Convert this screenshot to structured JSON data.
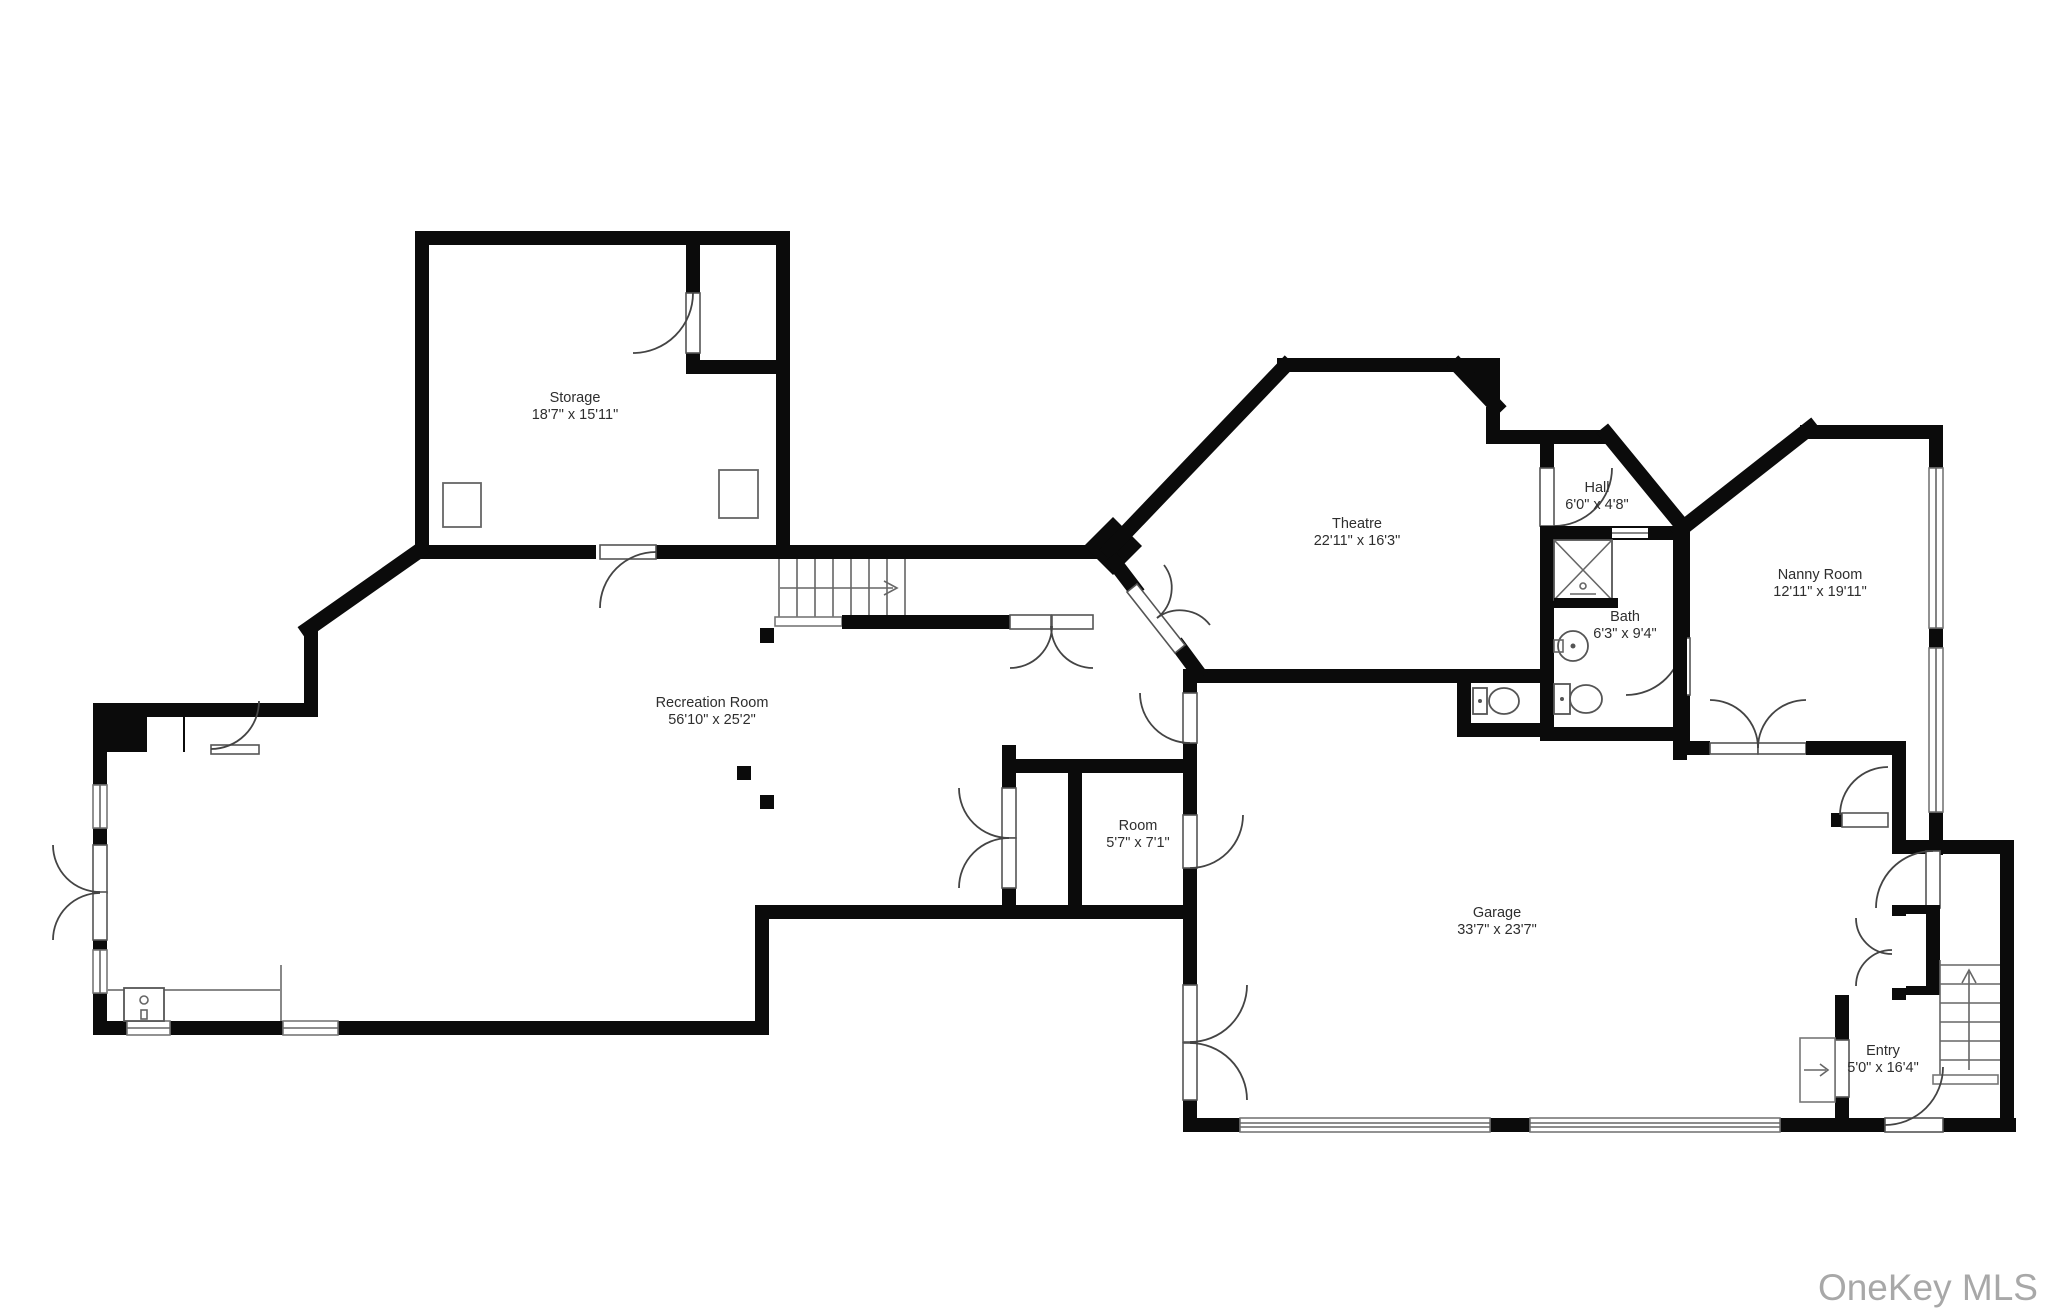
{
  "watermark": {
    "text": "OneKey MLS"
  },
  "rooms": [
    {
      "id": "storage",
      "name": "Storage",
      "dims": "18'7\" x 15'11\""
    },
    {
      "id": "recreation-room",
      "name": "Recreation Room",
      "dims": "56'10\" x 25'2\""
    },
    {
      "id": "theatre",
      "name": "Theatre",
      "dims": "22'11\" x 16'3\""
    },
    {
      "id": "hall",
      "name": "Hall",
      "dims": "6'0\" x 4'8\""
    },
    {
      "id": "bath",
      "name": "Bath",
      "dims": "6'3\" x 9'4\""
    },
    {
      "id": "nanny-room",
      "name": "Nanny Room",
      "dims": "12'11\" x 19'11\""
    },
    {
      "id": "room",
      "name": "Room",
      "dims": "5'7\" x 7'1\""
    },
    {
      "id": "garage",
      "name": "Garage",
      "dims": "33'7\" x 23'7\""
    },
    {
      "id": "entry",
      "name": "Entry",
      "dims": "5'0\" x 16'4\""
    }
  ],
  "colors": {
    "wall": "#0b0b0b",
    "label": "#2e2e2e",
    "watermark": "#a8a8a8",
    "fixture": "#555555"
  }
}
